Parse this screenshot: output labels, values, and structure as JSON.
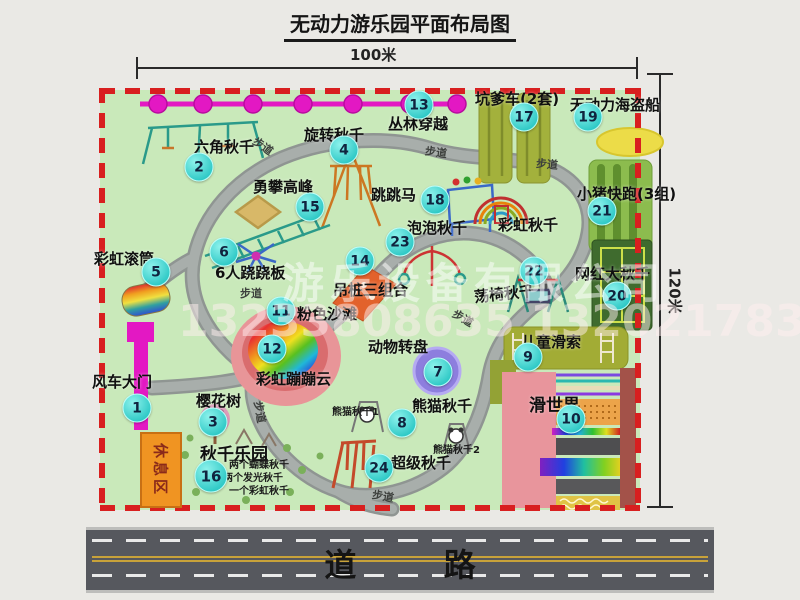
{
  "title": "无动力游乐园平面布局图",
  "dimensions": {
    "width": "100米",
    "height": "120米"
  },
  "road": {
    "label": "道 路"
  },
  "rest_area": {
    "label": "休息区"
  },
  "walkway_label": "步道",
  "watermark": {
    "company": "游乐设备有限公司",
    "phone": "13233808635 13202178333"
  },
  "items": [
    {
      "num": "1",
      "name": "风车大门"
    },
    {
      "num": "2",
      "name": "六角秋千"
    },
    {
      "num": "3",
      "name": "樱花树"
    },
    {
      "num": "4",
      "name": "旋转秋千"
    },
    {
      "num": "5",
      "name": "彩虹滚筒"
    },
    {
      "num": "6",
      "name": "6人跷跷板"
    },
    {
      "num": "7",
      "name": "动物转盘"
    },
    {
      "num": "8",
      "name": "熊猫秋千"
    },
    {
      "num": "9",
      "name": "儿童滑索"
    },
    {
      "num": "10",
      "name": "滑世界"
    },
    {
      "num": "11",
      "name": "粉色沙滩"
    },
    {
      "num": "12",
      "name": "彩虹蹦蹦云"
    },
    {
      "num": "13",
      "name": "丛林穿越"
    },
    {
      "num": "14",
      "name": "吊桩三组合"
    },
    {
      "num": "15",
      "name": "勇攀高峰"
    },
    {
      "num": "16",
      "name": "秋千乐园",
      "notes": [
        "两个蝴蝶秋千",
        "两个发光秋千",
        "一个彩虹秋千"
      ]
    },
    {
      "num": "17",
      "name": "坑爹车(2套)"
    },
    {
      "num": "18",
      "name": "跳跳马"
    },
    {
      "num": "19",
      "name": "无动力海盗船"
    },
    {
      "num": "20",
      "name": "网红大秋千"
    },
    {
      "num": "21",
      "name": "小猪快跑(3组)"
    },
    {
      "num": "22",
      "name": "荡椅秋千"
    },
    {
      "num": "23",
      "name": "泡泡秋千"
    },
    {
      "num": "24",
      "name": "超级秋千"
    },
    {
      "num": "",
      "name": "彩虹秋千"
    }
  ],
  "sub_labels": {
    "panda1": "熊猫秋千1",
    "panda2": "熊猫秋千2"
  }
}
